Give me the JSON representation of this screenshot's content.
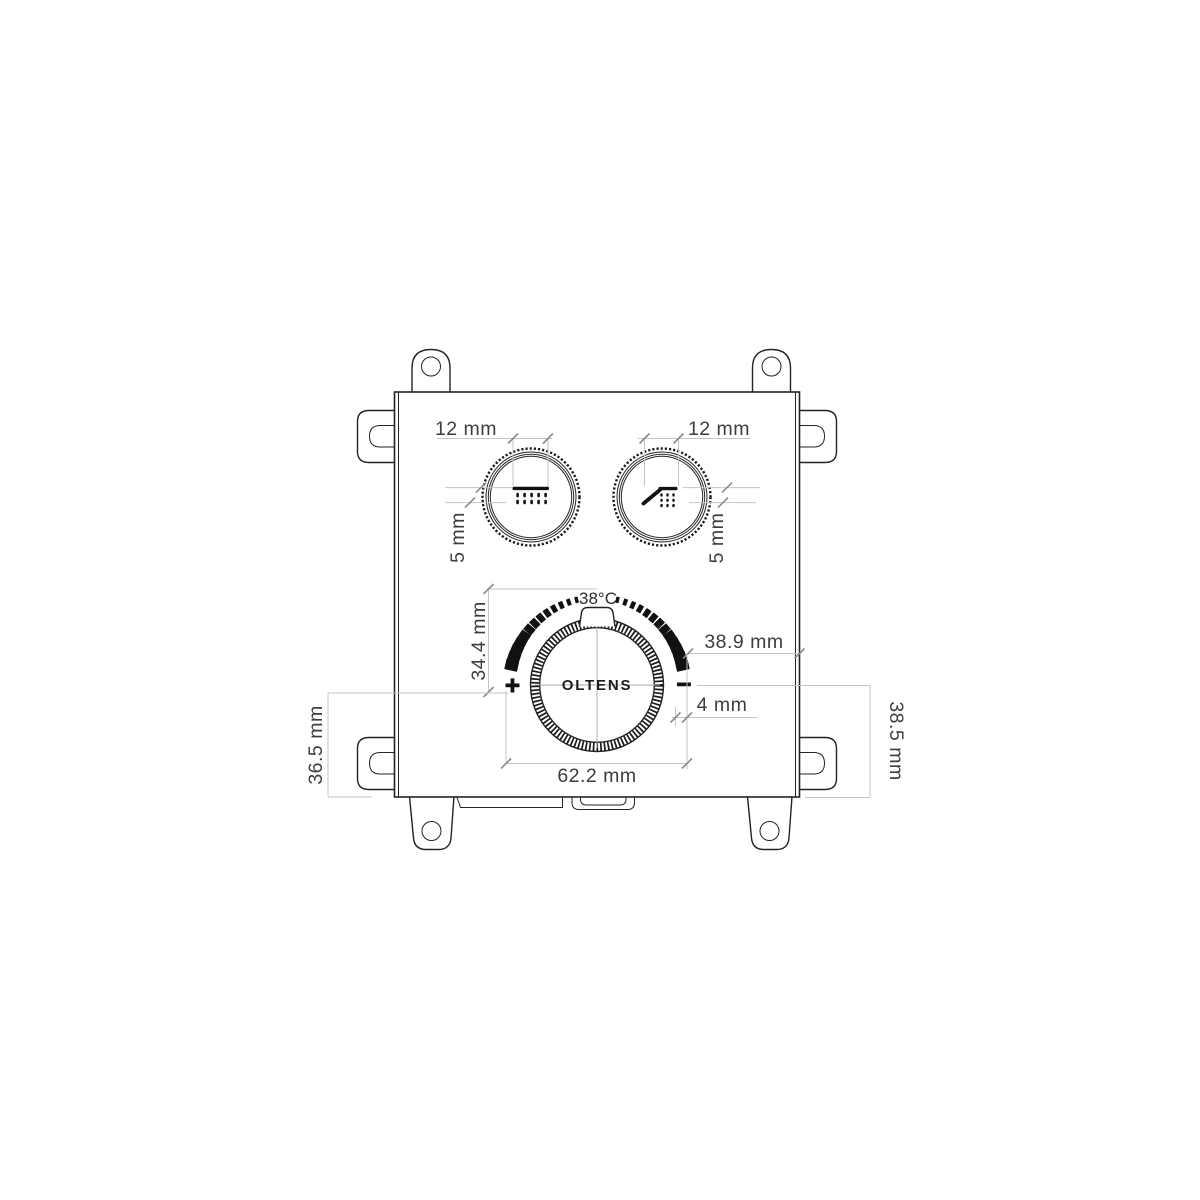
{
  "product": {
    "brand": "OLTENS",
    "temperature_label": "38°C",
    "plus_sign": "+",
    "minus_sign": "−"
  },
  "dimensions": {
    "knob_left_width": "12 mm",
    "knob_right_width": "12 mm",
    "knob_left_spray_height": "5 mm",
    "knob_right_spray_height": "5 mm",
    "scale_height": "34.4 mm",
    "scale_to_edge": "38.9 mm",
    "scale_gap": "4 mm",
    "thermostat_width": "62.2 mm",
    "bottom_left_offset": "36.5 mm",
    "bottom_right_offset": "38.5 mm"
  },
  "colors": {
    "line": "#232323",
    "dimension_line": "#c4c4c4",
    "dimension_text": "#3d3d3d",
    "ink": "#111111"
  }
}
